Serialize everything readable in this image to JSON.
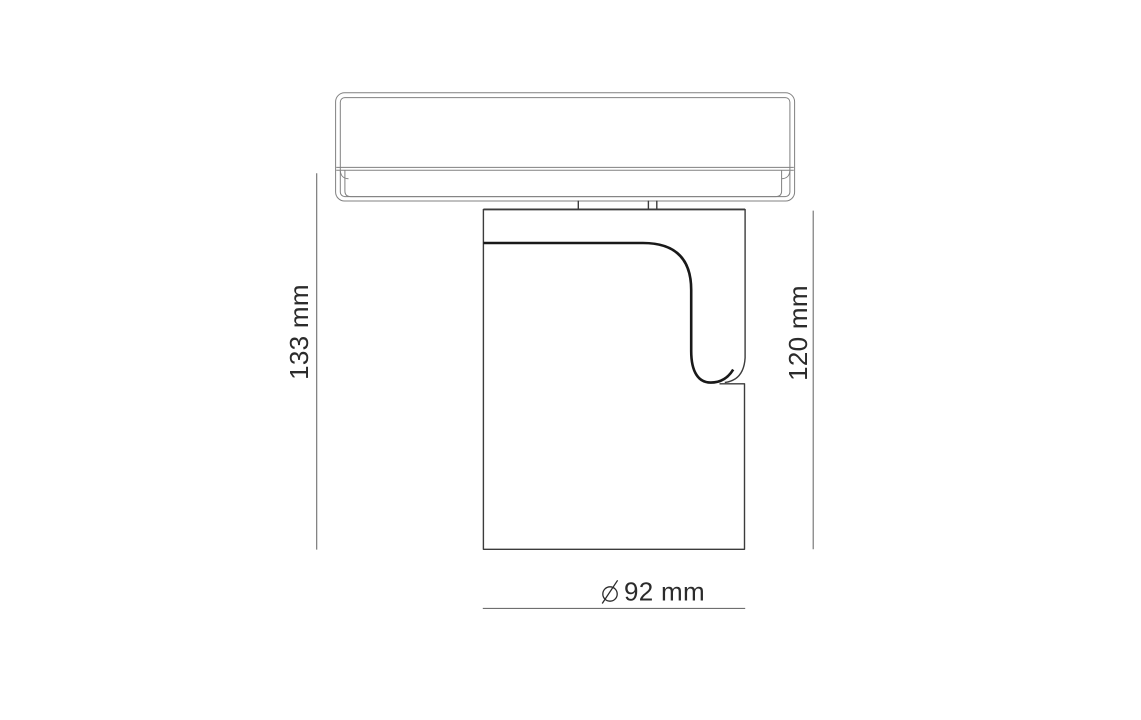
{
  "drawing": {
    "labels": {
      "overall_height": "133 mm",
      "body_height": "120 mm",
      "diameter": "92 mm",
      "diameter_symbol": "⌀"
    },
    "colors": {
      "background": "#ffffff",
      "profile": "#818181",
      "body": "#3c3c3c",
      "accent": "#191919",
      "dim": "#6f6f6f",
      "text": "#2b2b2b"
    }
  }
}
